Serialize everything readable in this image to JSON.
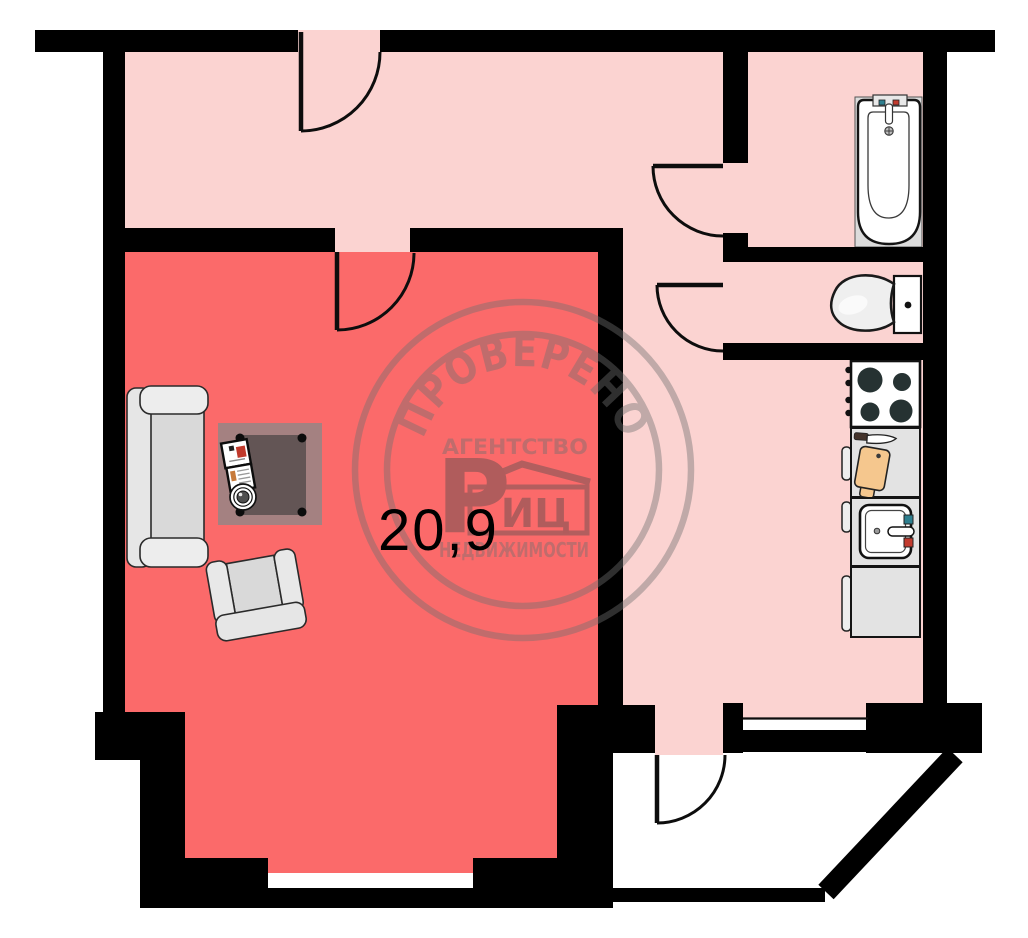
{
  "floor_plan": {
    "title": "apartment-floor-plan",
    "area_label": "20,9",
    "watermark": {
      "arc_text": "ПРОВЕРЕНО",
      "agency_line": "АГЕНТСТВО",
      "logo_letter": "Р",
      "logo_box_text": "ИЦ",
      "realty_line": "НЕДВИЖИМОСТИ"
    },
    "rooms": [
      {
        "name": "living-room",
        "area": "20,9"
      },
      {
        "name": "hallway",
        "area": ""
      },
      {
        "name": "bathroom",
        "area": ""
      },
      {
        "name": "toilet",
        "area": ""
      },
      {
        "name": "kitchen",
        "area": ""
      },
      {
        "name": "balcony",
        "area": ""
      }
    ],
    "fixtures": [
      "bathtub",
      "toilet",
      "stove",
      "cutting-board-counter",
      "kitchen-sink",
      "kitchen-cabinet",
      "sofa",
      "coffee-table",
      "open-book",
      "cup",
      "armchair"
    ],
    "colors": {
      "living": "#fb6a6a",
      "hallway": "#fbd3d1",
      "wall": "#000000",
      "fixture_light": "#e3e3e3",
      "bath_panel": "#dcdcdc",
      "cutting_board": "#f5c78e",
      "tap_cold": "#2e7f8f",
      "tap_hot": "#c23b2e",
      "table": "#a48181",
      "table_top": "#635555",
      "watermark": "#707070",
      "area_text": "#000000"
    }
  }
}
